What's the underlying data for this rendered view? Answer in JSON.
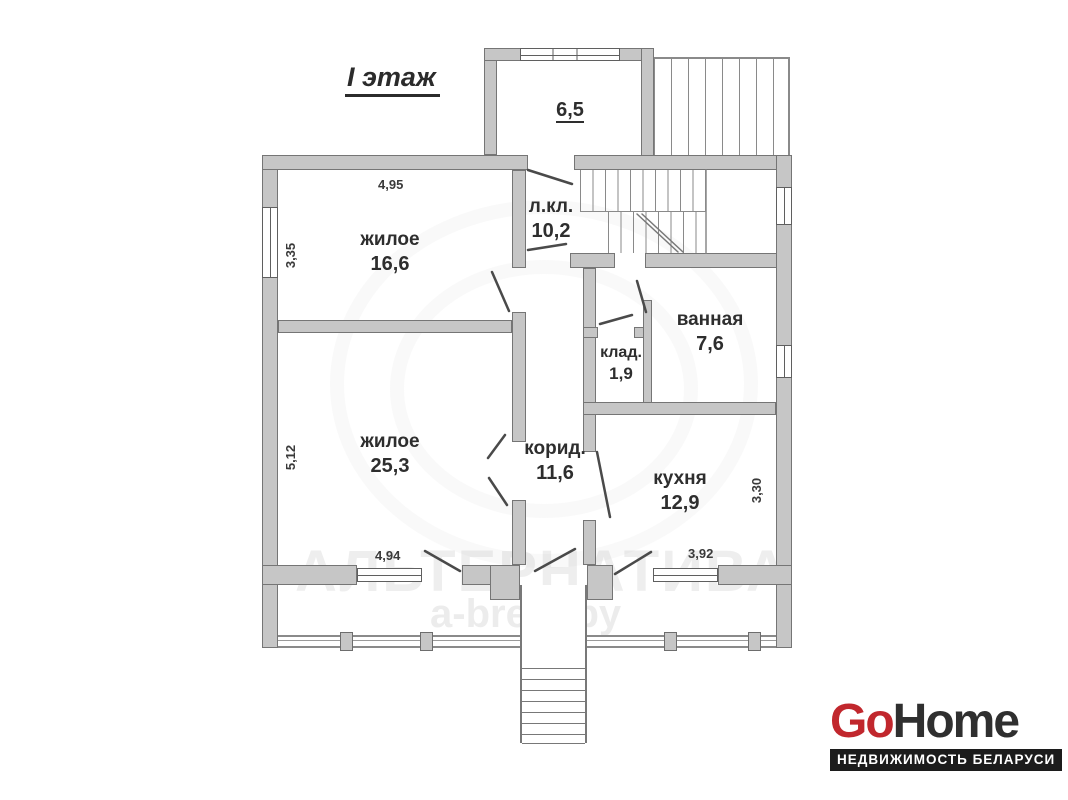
{
  "title": "I этаж",
  "rooms": {
    "r166": {
      "label": "жилое",
      "area": "16,6"
    },
    "r253": {
      "label": "жилое",
      "area": "25,3"
    },
    "lkl": {
      "label": "л.кл.",
      "area": "10,2"
    },
    "klad": {
      "label": "клад.",
      "area": "1,9"
    },
    "bath": {
      "label": "ванная",
      "area": "7,6"
    },
    "corridor": {
      "label": "корид.",
      "area": "11,6"
    },
    "kitchen": {
      "label": "кухня",
      "area": "12,9"
    },
    "porch": {
      "label": "",
      "area": "6,5"
    }
  },
  "dimensions": {
    "d495": "4,95",
    "d335": "3,35",
    "d512": "5,12",
    "d494": "4,94",
    "d392": "3,92",
    "d330": "3,30"
  },
  "watermark": {
    "line1": "АЛЬТЕРНАТИВА",
    "line2": "a-brest.by"
  },
  "logo": {
    "go": "Go",
    "home": "Home",
    "tagline": "НЕДВИЖИМОСТЬ БЕЛАРУСИ"
  },
  "colors": {
    "wall": "#c6c6c6",
    "wall_border": "#757575",
    "line": "#4a4a4a",
    "logo_red": "#c1272d",
    "logo_dark": "#2f2f2f",
    "logo_bar": "#1c1c1c"
  }
}
